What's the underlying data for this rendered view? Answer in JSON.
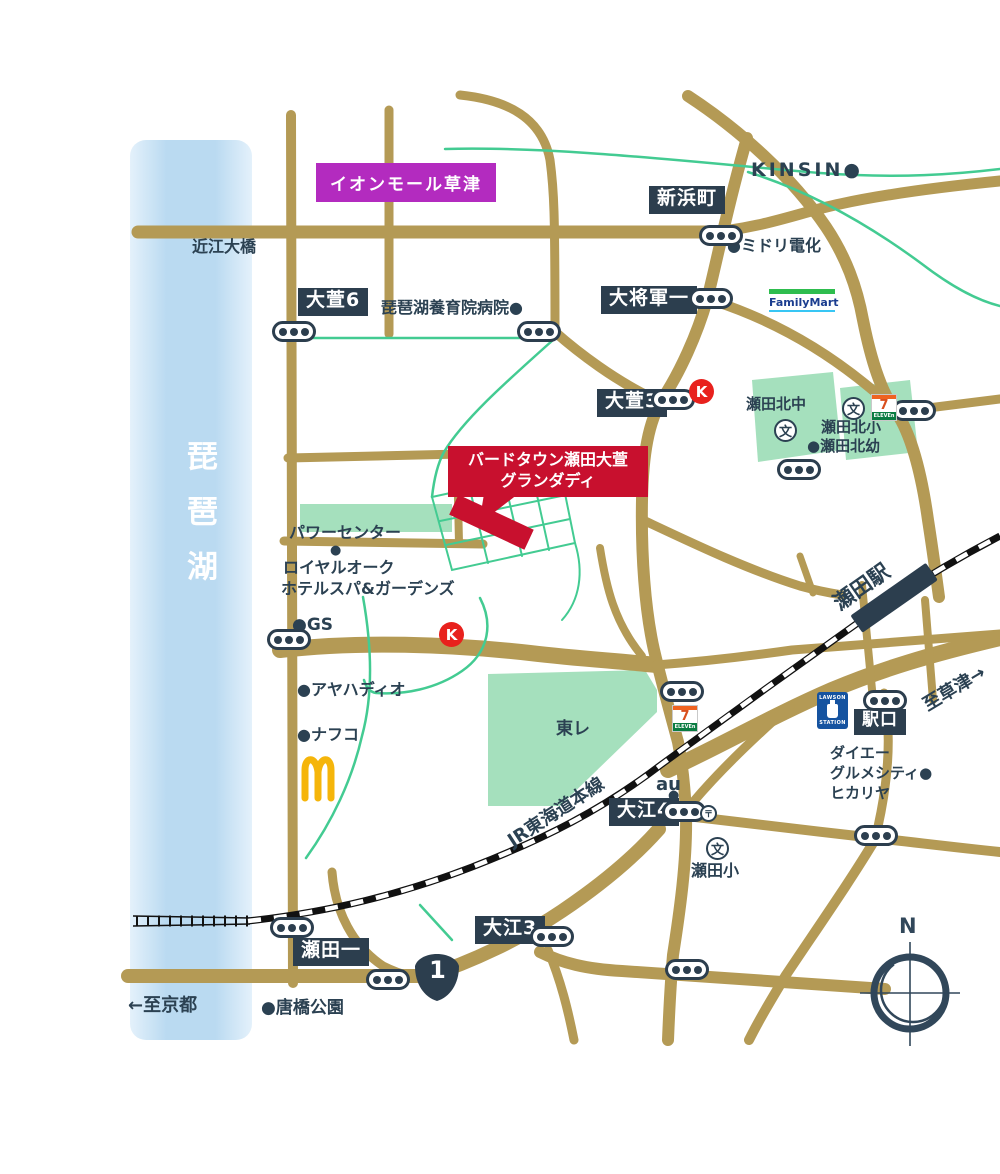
{
  "map": {
    "badges": {
      "shinhama": "新浜町",
      "ogaya6": "大萱6",
      "daishogun": "大将軍一",
      "ogaya3": "大萱3",
      "oe4": "大江4",
      "oe3": "大江3",
      "seta1": "瀬田一",
      "ekiguchi": "駅口"
    },
    "highlight": {
      "aeon_mall": "イオンモール草津",
      "callout_line1": "バードタウン瀬田大萱",
      "callout_line2": "グランダディ"
    },
    "labels": {
      "kinsin": "KINSIN●",
      "midori_denka": "●ミドリ電化",
      "omi_ohashi": "近江大橋",
      "hospital": "琵琶湖養育院病院●",
      "power_center": "パワーセンター",
      "hotel_dot": "●",
      "royal_oak_1": "ロイヤルオーク",
      "royal_oak_2": "ホテルスパ&ガーデンズ",
      "gs": "●GS",
      "ayaha_dio": "●アヤハディオ",
      "nafco": "●ナフコ",
      "toray": "東レ",
      "au": "au",
      "au_dot": "●",
      "seta_elementary": "瀬田小",
      "daiei": "ダイエー",
      "gourmet_city": "グルメシティ●",
      "hikariya": "ヒカリヤ",
      "setakita_junior_high": "瀬田北中",
      "setakita_elementary": "瀬田北小",
      "setakita_kindergarten": "●瀬田北幼",
      "karahashi_park": "●唐橋公園",
      "to_kyoto": "←至京都",
      "to_kusatsu": "至草津→",
      "jr_tokaido_line": "JR東海道本線",
      "seta_station": "瀬田駅",
      "lake_biwa": "琵琶湖",
      "north": "N"
    },
    "icons": {
      "school": "文",
      "circle_k": "K",
      "post_office": "〒",
      "seven": "7",
      "seven_eleven": "ELEVEn",
      "lawson": "LAWSON",
      "lawson_station": "STATION",
      "family_mart": "FamilyMart",
      "route_1": "1"
    },
    "colors": {
      "road": "#b49a55",
      "navy": "#2c3e4e",
      "teal": "#43cb92",
      "green_area": "#a5e0bd",
      "lake": "#bedcf2",
      "site_red": "#c8102e",
      "aeon_purple": "#b32bbf",
      "mcdonalds_yellow": "#f5b50a"
    }
  }
}
